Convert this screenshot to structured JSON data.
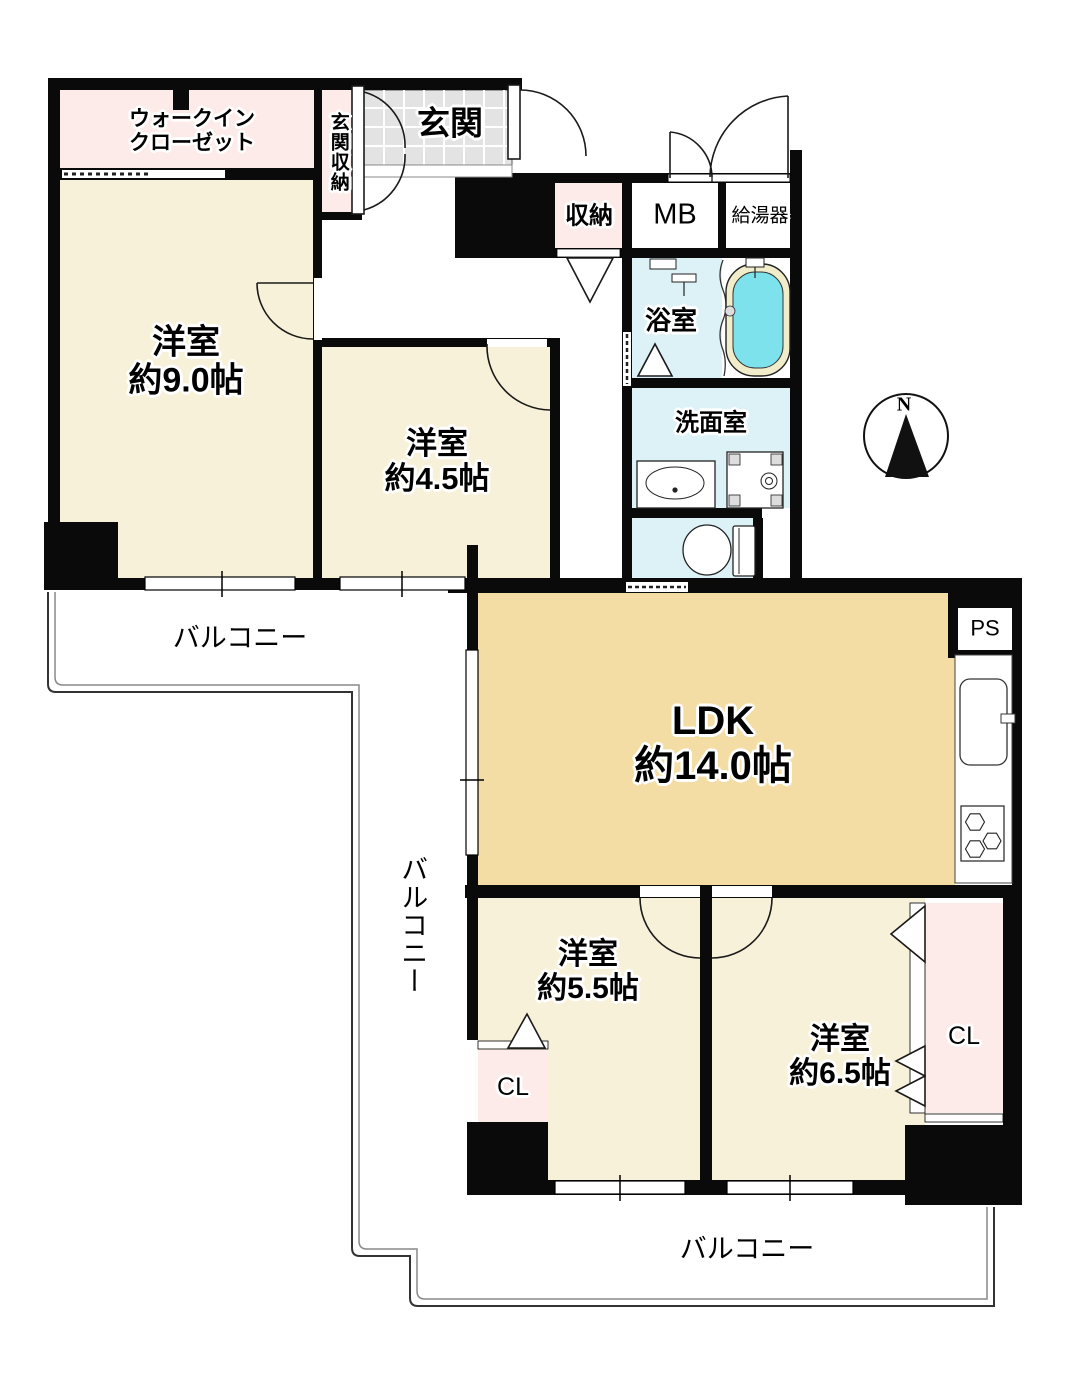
{
  "floorplan": {
    "compass": {
      "north": "N"
    },
    "rooms": {
      "wic": {
        "line1": "ウォークイン",
        "line2": "クローゼット"
      },
      "genkan_storage": {
        "label": "玄関収納"
      },
      "genkan": {
        "label": "玄関"
      },
      "storage": {
        "label": "収納"
      },
      "meter_box": {
        "label": "MB"
      },
      "water_heater": {
        "label": "給湯器"
      },
      "bathroom": {
        "label": "浴室"
      },
      "washroom": {
        "label": "洗面室"
      },
      "room_9": {
        "name": "洋室",
        "size": "約9.0帖"
      },
      "room_45": {
        "name": "洋室",
        "size": "約4.5帖"
      },
      "ldk": {
        "name": "LDK",
        "size": "約14.0帖"
      },
      "room_55": {
        "name": "洋室",
        "size": "約5.5帖"
      },
      "room_65": {
        "name": "洋室",
        "size": "約6.5帖"
      },
      "closet_small": {
        "label": "CL"
      },
      "closet_large": {
        "label": "CL"
      },
      "pipe_space": {
        "label": "PS"
      }
    },
    "balconies": {
      "left": {
        "label": "バルコニー"
      },
      "middle": {
        "label": "バルコニー"
      },
      "bottom": {
        "label": "バルコニー"
      }
    },
    "colors": {
      "room_floor": "#f8f1da",
      "ldk_floor": "#f4dda4",
      "closet_pink": "#fcebe8",
      "wet_floor": "#dcf2f7",
      "tub_water": "#7de2ec",
      "tub_rim": "#f1ecca",
      "tile_gray": "#e3e3e3",
      "wall": "#0a0a0a"
    }
  }
}
